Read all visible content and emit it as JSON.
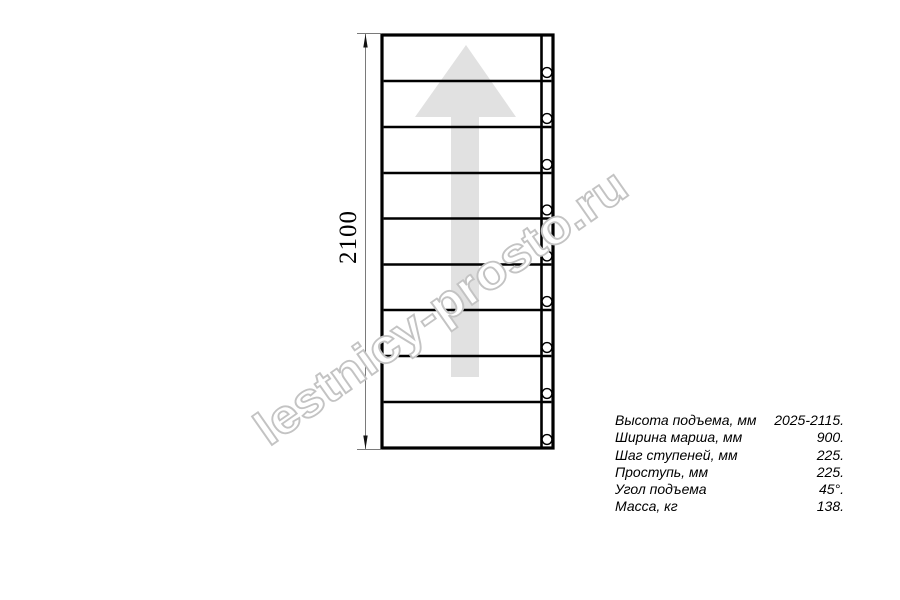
{
  "watermark": {
    "text": "lestnicy-prosto.ru"
  },
  "dimension": {
    "label": "2100"
  },
  "specs": {
    "rows": [
      {
        "label": "Высота подъема, мм",
        "value": "2025-2115."
      },
      {
        "label": "Ширина марша, мм",
        "value": "900."
      },
      {
        "label": "Шаг ступеней, мм",
        "value": "225."
      },
      {
        "label": "Проступь, мм",
        "value": "225."
      },
      {
        "label": "Угол подъема",
        "value": "45°."
      },
      {
        "label": "Масса, кг",
        "value": "138."
      }
    ]
  },
  "drawing": {
    "steps_count": 9,
    "bolt_holes_count": 9
  },
  "colors": {
    "line": "#000000",
    "arrow_fill": "#e1e1e1",
    "watermark_stroke": "#c3c3c3",
    "dim_line": "#7a7a7a",
    "dim_arrow": "#111111"
  }
}
